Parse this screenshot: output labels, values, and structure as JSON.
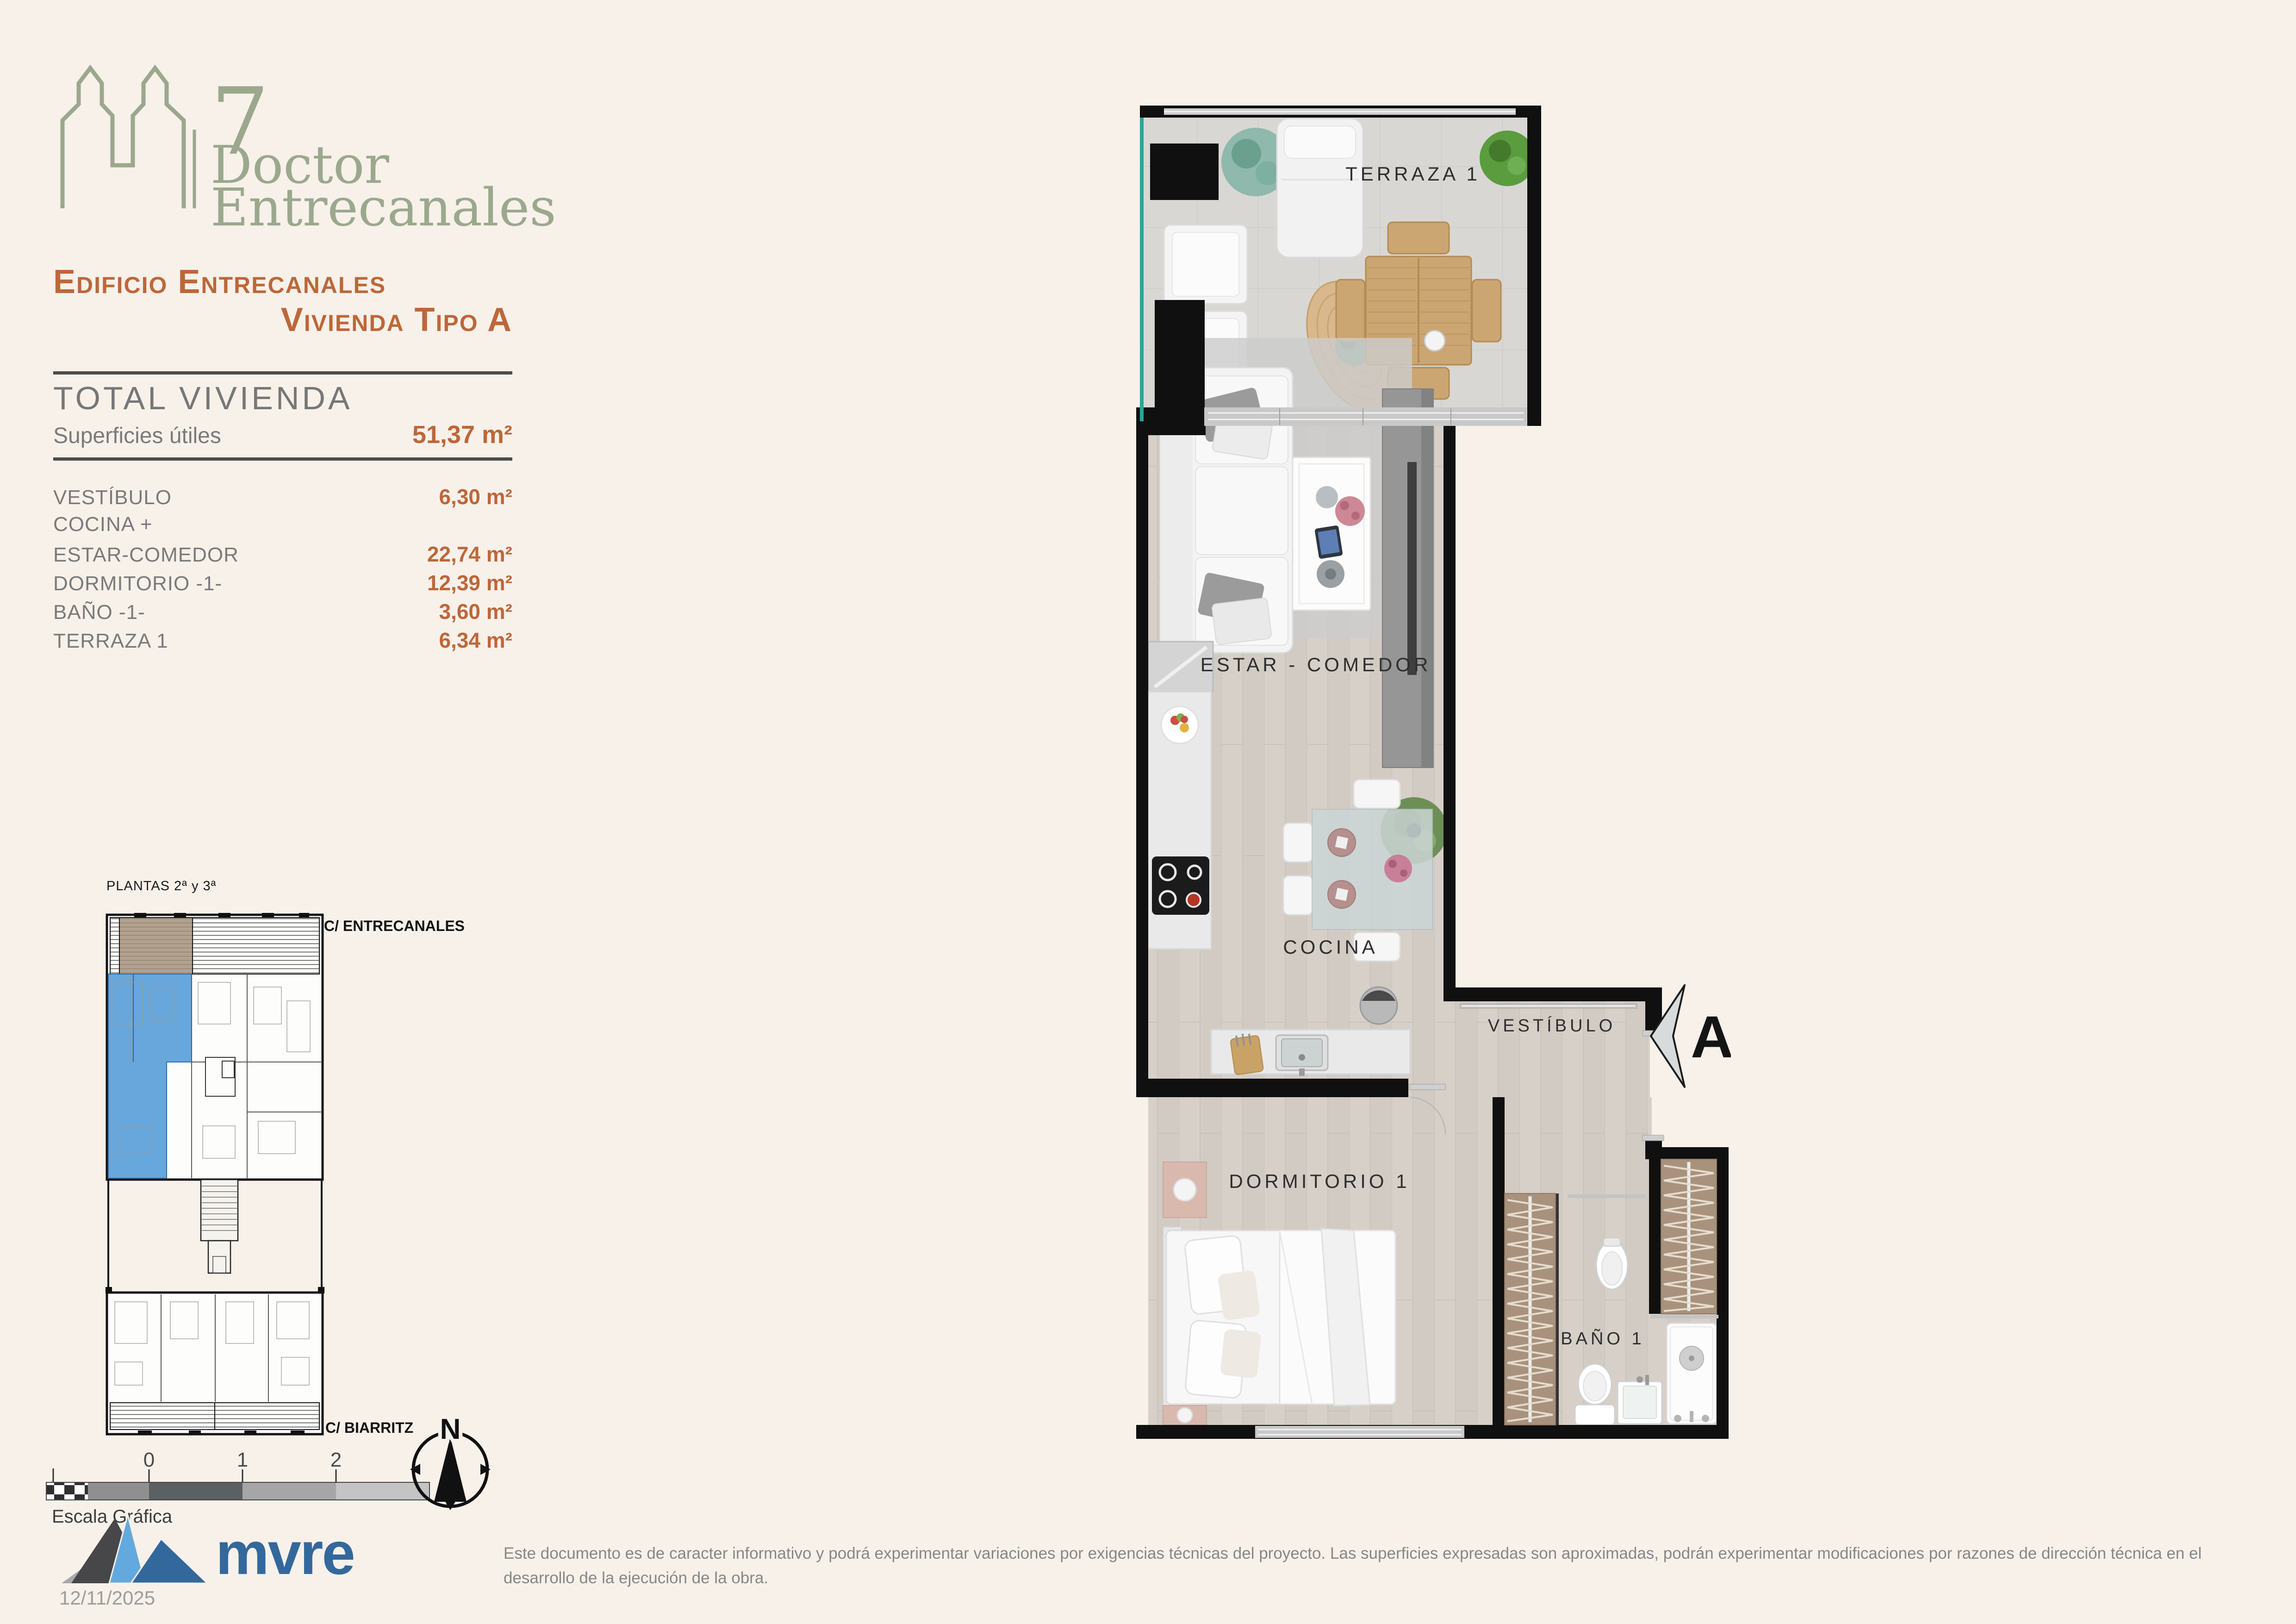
{
  "brand": {
    "number": "7",
    "line1": "Doctor",
    "line2": "Entrecanales"
  },
  "title": {
    "line1": "Edificio Entrecanales",
    "line2": "Vivienda Tipo A"
  },
  "summary": {
    "heading": "TOTAL VIVIENDA",
    "label": "Superficies útiles",
    "value": "51,37 m²"
  },
  "rooms": [
    {
      "label": "VESTÍBULO",
      "value": "6,30 m²"
    },
    {
      "label": "COCINA +",
      "value": ""
    },
    {
      "label": "ESTAR-COMEDOR",
      "value": "22,74 m²"
    },
    {
      "label": "DORMITORIO -1-",
      "value": "12,39 m²"
    },
    {
      "label": "BAÑO -1-",
      "value": "3,60 m²"
    },
    {
      "label": "TERRAZA 1",
      "value": "6,34 m²"
    }
  ],
  "keyplan": {
    "title": "PLANTAS 2ª y 3ª",
    "street_top": "C/ ENTRECANALES",
    "street_bottom": "C/ BIARRITZ",
    "scale_label": "Escala Gráfica",
    "scale_ticks": [
      "0",
      "1",
      "2"
    ],
    "north_label": "N",
    "highlight_color": "#67a7dc"
  },
  "plan": {
    "labels": {
      "terraza": "TERRAZA 1",
      "estar": "ESTAR - COMEDOR",
      "cocina": "COCINA",
      "vestibulo": "VESTÍBULO",
      "dormitorio": "DORMITORIO 1",
      "bano": "BAÑO 1"
    },
    "entrance_marker": "A"
  },
  "footer": {
    "logo_text": "mvre",
    "date": "12/11/2025",
    "disclaimer": "Este documento es de caracter informativo y podrá experimentar variaciones por exigencias técnicas del proyecto. Las superficies expresadas son aproximadas, podrán experimentar modificaciones por razones de dirección técnica en el desarrollo de la ejecución de la obra."
  },
  "colors": {
    "accent": "#bd6739",
    "text_gray": "#7a7a7a",
    "logo_green": "#9ba88e",
    "mvre_blue": "#33689c",
    "highlight_blue": "#67a7dc",
    "background": "#f7f1ea",
    "wall_black": "#101010"
  }
}
